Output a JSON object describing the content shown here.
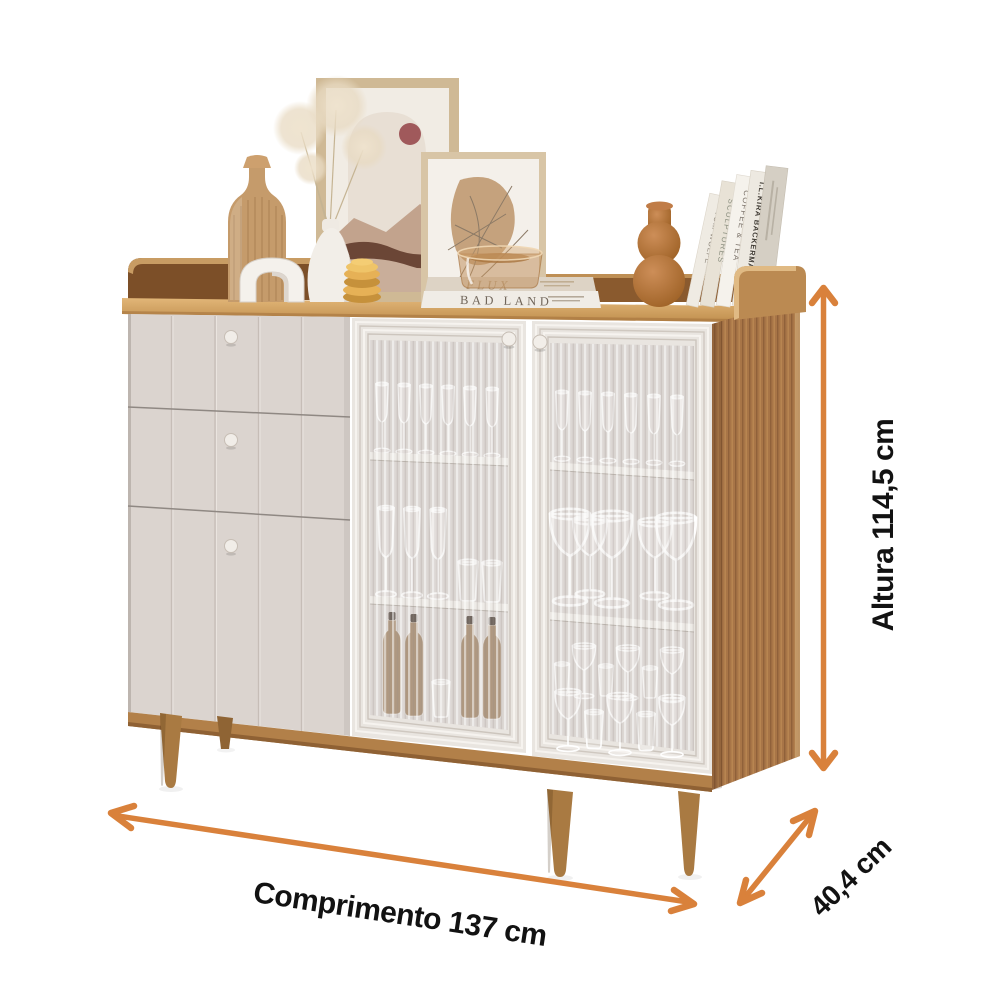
{
  "annotations": {
    "height_label": "Altura 114,5 cm",
    "length_label": "Comprimento 137 cm",
    "depth_label": "40,4 cm",
    "arrow_color": "#D9813B",
    "label_color": "#121212"
  },
  "decor_text": {
    "stacked_books": [
      {
        "title": "FLUX"
      },
      {
        "title": "BAD LAND"
      }
    ],
    "standing_books": [
      {
        "title": "TOM WOLFE"
      },
      {
        "title": "SCULPTURES"
      },
      {
        "title": "COFFEE & TEA"
      },
      {
        "title": "I.L.KIRA BACKERMAN"
      }
    ]
  },
  "palette": {
    "background": "#FFFFFF",
    "wood_top": "#D2A466",
    "wood_side": "#A87547",
    "wood_rail_dark": "#7C4F28",
    "wood_rail_light": "#BB8A52",
    "wood_base": "#B28049",
    "leg_wood": "#A97A42",
    "cream_panel": "#DBD4CF",
    "door_frame": "#E9E5E0",
    "glass_interior": "#D8D2CE",
    "shelf_white": "#F1EEE9",
    "terracotta": "#B5713F",
    "gold": "#E6B156"
  }
}
